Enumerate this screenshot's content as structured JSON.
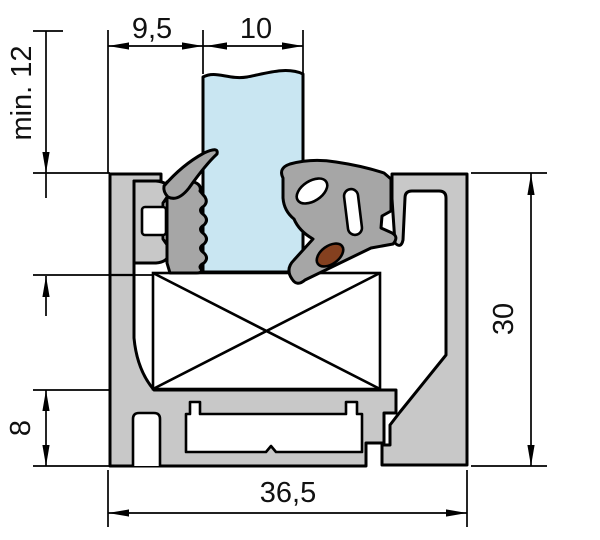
{
  "drawing": {
    "kind": "window-frame-profile-cross-section",
    "labels": {
      "dim_bead_width": "9,5",
      "dim_glass_thickness": "10",
      "dim_min_glass_cover": "min. 12",
      "dim_profile_height": "30",
      "dim_base_height": "8",
      "dim_profile_width": "36,5"
    },
    "colors": {
      "aluminum": "#c8c8c8",
      "gasket": "#a6a6a6",
      "glass": "#c9e6f2",
      "wedge": "#84401f",
      "outline": "#000000",
      "cutout": "#ffffff",
      "background": "#ffffff"
    }
  }
}
